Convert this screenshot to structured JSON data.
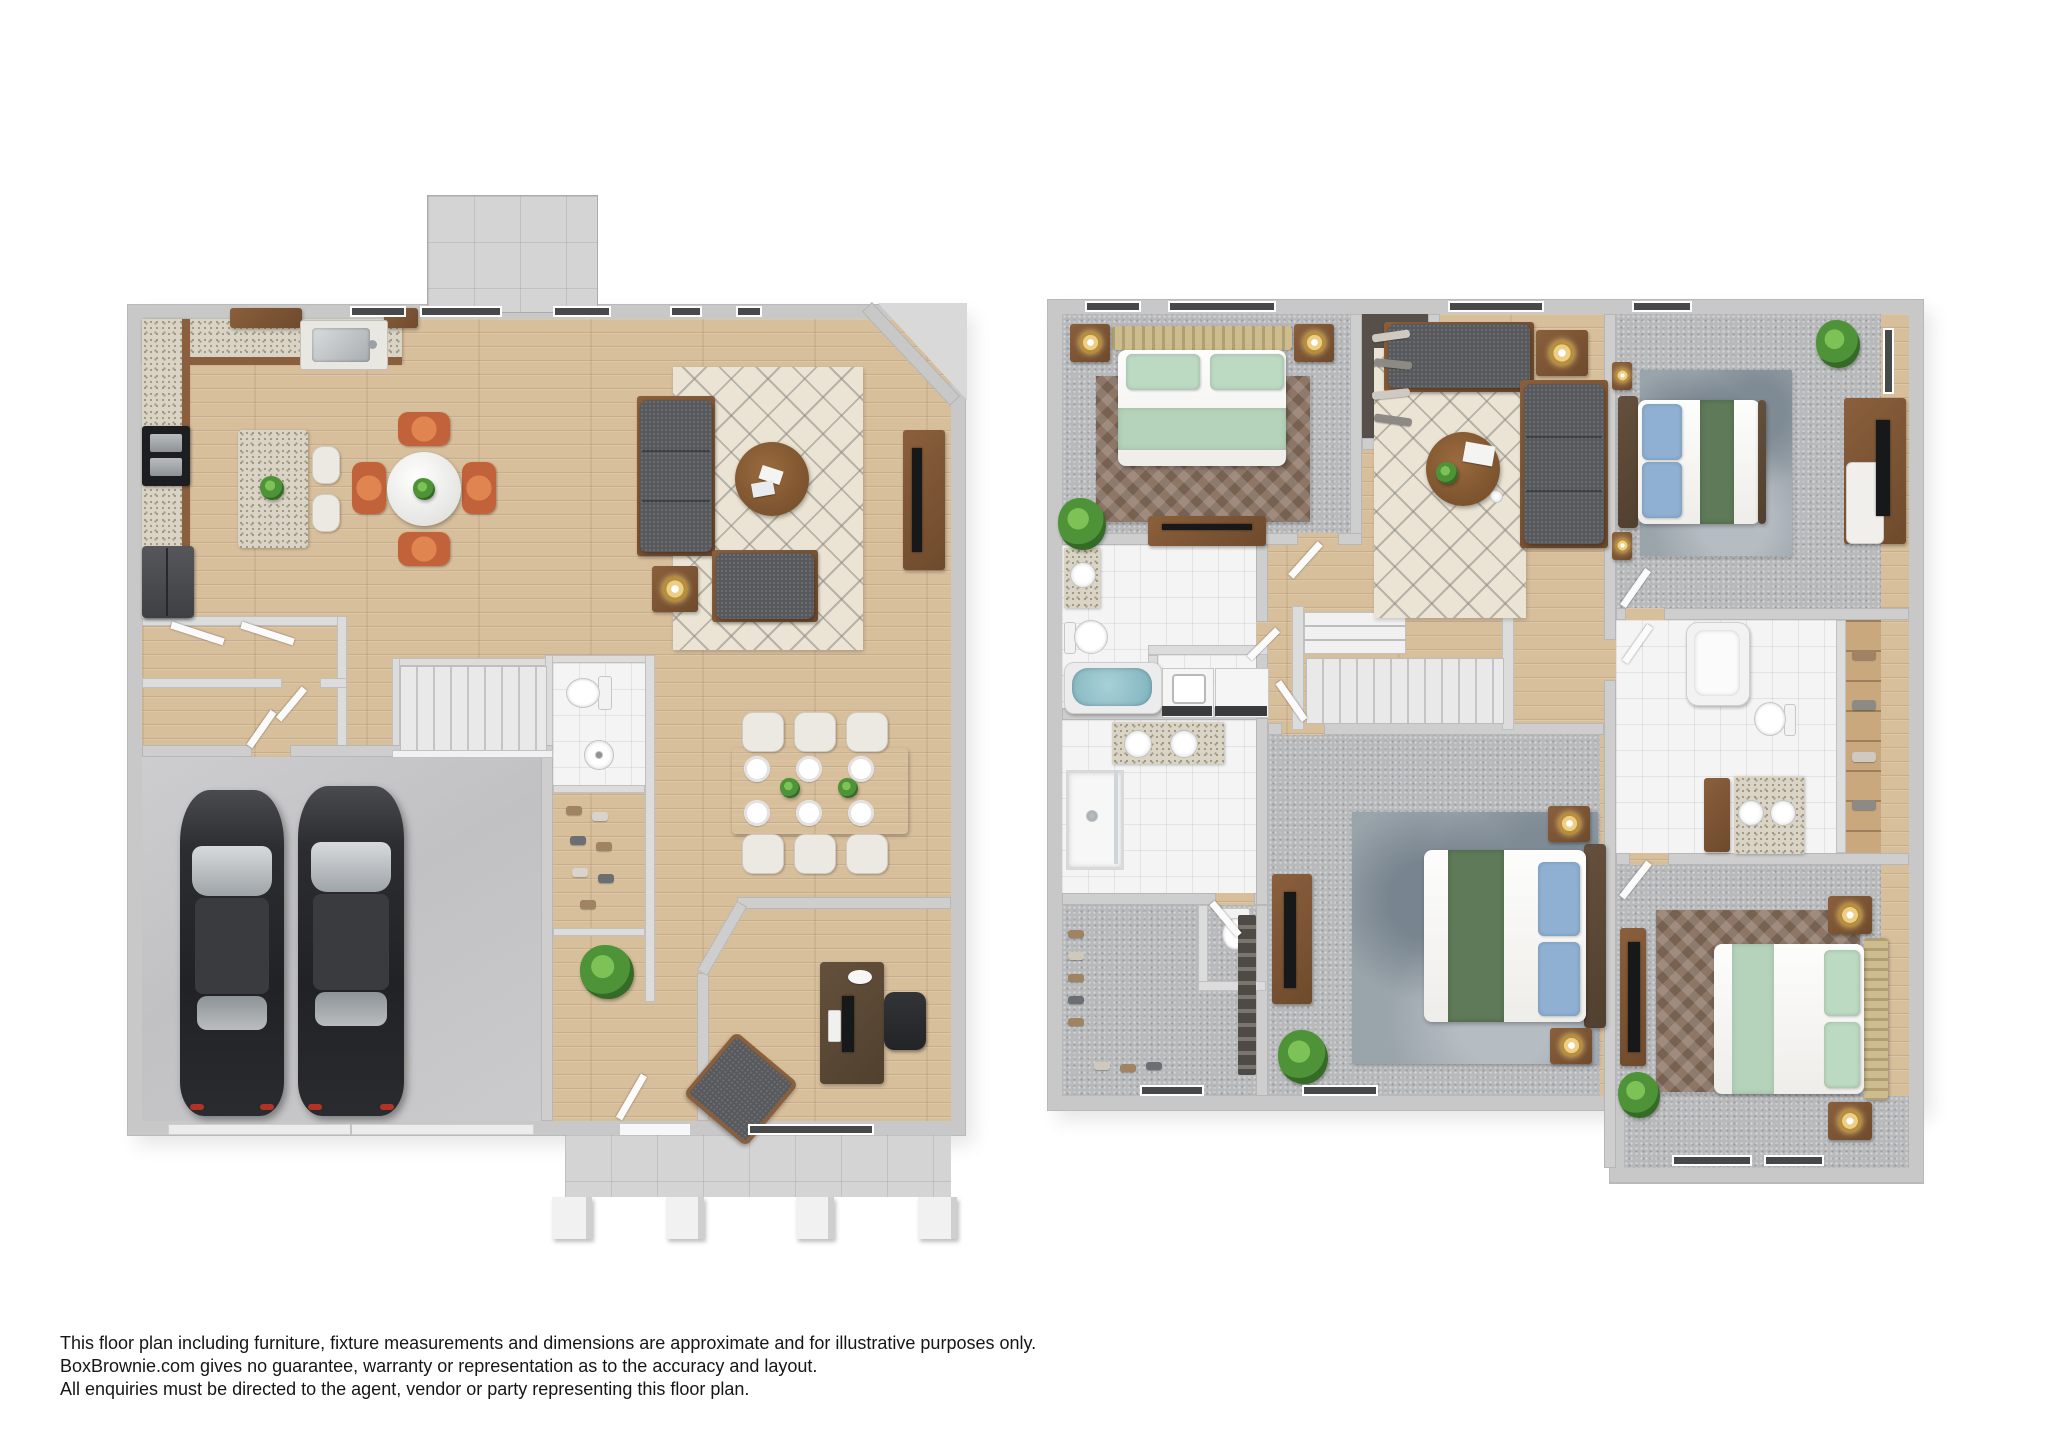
{
  "disclaimer": {
    "lines": [
      "This floor plan including furniture, fixture measurements and dimensions are approximate and for illustrative purposes only.",
      "BoxBrownie.com gives no guarantee, warranty or representation as to the accuracy and layout.",
      "All enquiries must be directed to the agent, vendor or party representing this floor plan."
    ]
  },
  "plans": {
    "first_floor": {
      "id": "first-floor-plan",
      "rooms": [
        "kitchen",
        "breakfast-bar-island",
        "breakfast-nook",
        "living-room",
        "formal-dining-room",
        "entry-closets",
        "staircase",
        "powder-room",
        "shoe-closet",
        "hallway",
        "two-car-garage",
        "home-office",
        "front-porch",
        "patio-chimney"
      ],
      "fixtures": {
        "cars": 2,
        "dining_seats": 6,
        "nook_seats": 4,
        "bar_stools": 2,
        "sofas": 2
      }
    },
    "second_floor": {
      "id": "second-floor-plan",
      "rooms": [
        "bedroom-front",
        "walk-in-closet-small",
        "loft-lounge",
        "bedroom-corner",
        "hall-bathroom",
        "laundry-closet",
        "staircase",
        "master-bathroom",
        "water-closet",
        "master-walk-in-closet",
        "master-bedroom",
        "shared-bathroom",
        "linen-closet",
        "bedroom-rear"
      ],
      "fixtures": {
        "beds": 4,
        "bathtubs": 2,
        "showers": 1,
        "washer_dryer": 2,
        "sofas": 2
      }
    }
  },
  "colors": {
    "wall": "#c8c8c8",
    "wood_floor": "#d8bf9c",
    "carpet": "#b8b9bb",
    "tile": "#f4f4f4",
    "concrete": "#c6c6c8",
    "rug_cream": "#ebe4d4",
    "rug_brown": "#8d7666",
    "rug_blue": "#9aa4ab",
    "sofa_gray": "#58595c",
    "chair_orange": "#c2623a",
    "bed_green": "#b5d2ba",
    "runner_green": "#5e7a58",
    "pillow_blue": "#8fb0d3",
    "tub_blue": "#8fc0ca",
    "furniture_wood": "#7d5638",
    "lamp_gold": "#c9a04e",
    "plant_green": "#4f9338",
    "car_black": "#2b2c2f"
  }
}
